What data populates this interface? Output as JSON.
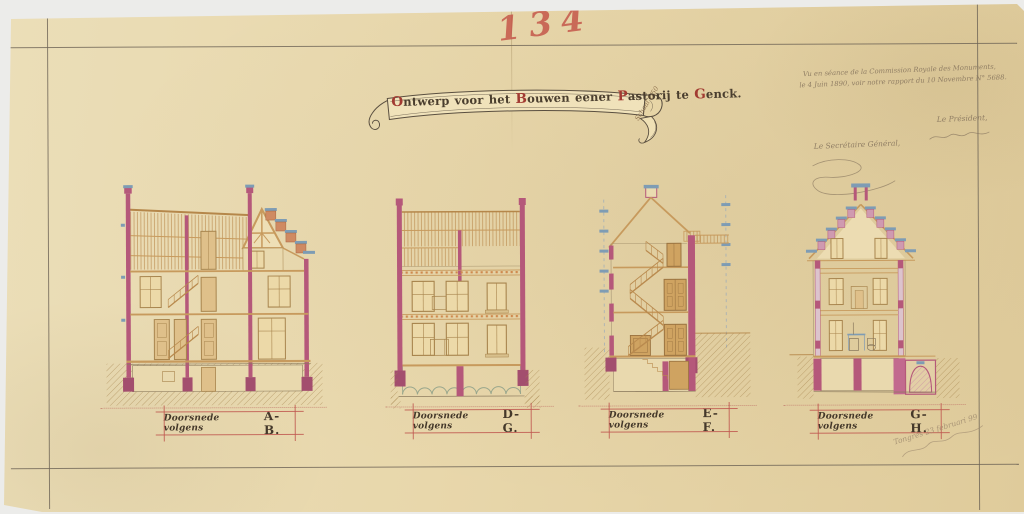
{
  "document": {
    "number_annotation": "134"
  },
  "title_banner": {
    "text": "Ontwerp voor het Bouwen eener Pastorij te Genck.",
    "parts": [
      {
        "t": "O",
        "red": true
      },
      {
        "t": "ntwerp voor het ",
        "red": false
      },
      {
        "t": "B",
        "red": true
      },
      {
        "t": "ouwen eener ",
        "red": false
      },
      {
        "t": "P",
        "red": true
      },
      {
        "t": "astorij te ",
        "red": false
      },
      {
        "t": "G",
        "red": true
      },
      {
        "t": "enck.",
        "red": false
      }
    ],
    "scale_note": "Schaal 1/50"
  },
  "approval_note": {
    "line1": "Vu en séance de la Commission Royale des Monuments,",
    "line2": "le 4 Juin 1890, voir notre rapport du 10 Novembre N° 5688.",
    "secretary_label": "Le Secrétaire Général,",
    "president_label": "Le Président,"
  },
  "sections": [
    {
      "id": "ab",
      "label_prefix": "Doorsnede volgens",
      "letters": "A-B."
    },
    {
      "id": "dg",
      "label_prefix": "Doorsnede volgens",
      "letters": "D-G."
    },
    {
      "id": "ef",
      "label_prefix": "Doorsnede volgens",
      "letters": "E-F."
    },
    {
      "id": "gh",
      "label_prefix": "Doorsnede volgens",
      "letters": "G-H."
    }
  ],
  "pencil_note": {
    "text": "Tongres 23 februari 99"
  },
  "colors": {
    "scan_background": "#ececea",
    "paper": "#e8d7ab",
    "ink_frame": "#6e6456",
    "cut_wall_pink": "#b5587a",
    "wood_tan": "#c79a5d",
    "brick_orange": "#cf8a62",
    "accent_blue": "#7e9cb4",
    "label_red": "#bf5850",
    "number_red": "#c5574a",
    "ground_hatch": "#a5824b"
  }
}
